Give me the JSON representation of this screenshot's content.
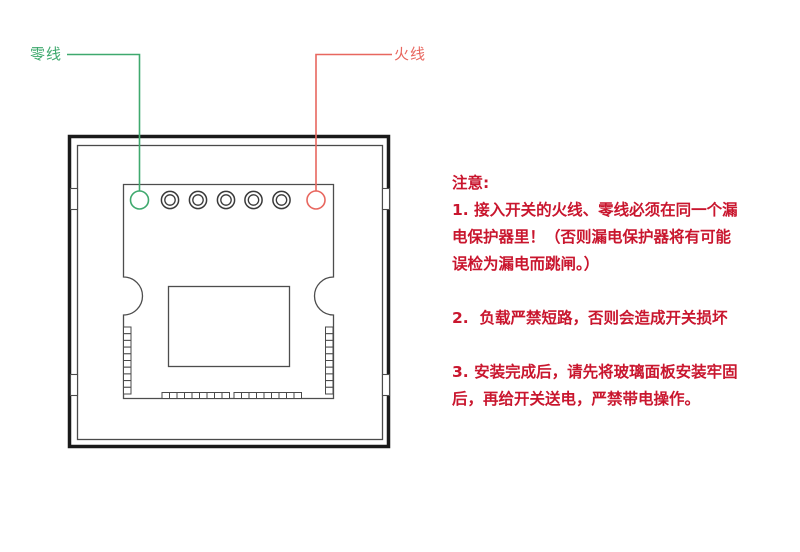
{
  "wiring": {
    "neutral_label": "零线",
    "live_label": "火线"
  },
  "notes": {
    "title": "注意:",
    "lines": [
      "1. 接入开关的火线、零线必须在同一个漏",
      "电保护器里！（否则漏电保护器将有可能",
      "误检为漏电而跳闸。）",
      "",
      "2.  负载严禁短路，否则会造成开关损坏",
      "",
      "3. 安装完成后，请先将玻璃面板安装牢固",
      "后，再给开关送电，严禁带电操作。"
    ]
  },
  "colors": {
    "neutral_wire": "#3fa96e",
    "live_wire": "#e8675f",
    "notes_text": "#c9162e",
    "outline": "#4d4d4d",
    "frame": "#1a1a1a"
  }
}
